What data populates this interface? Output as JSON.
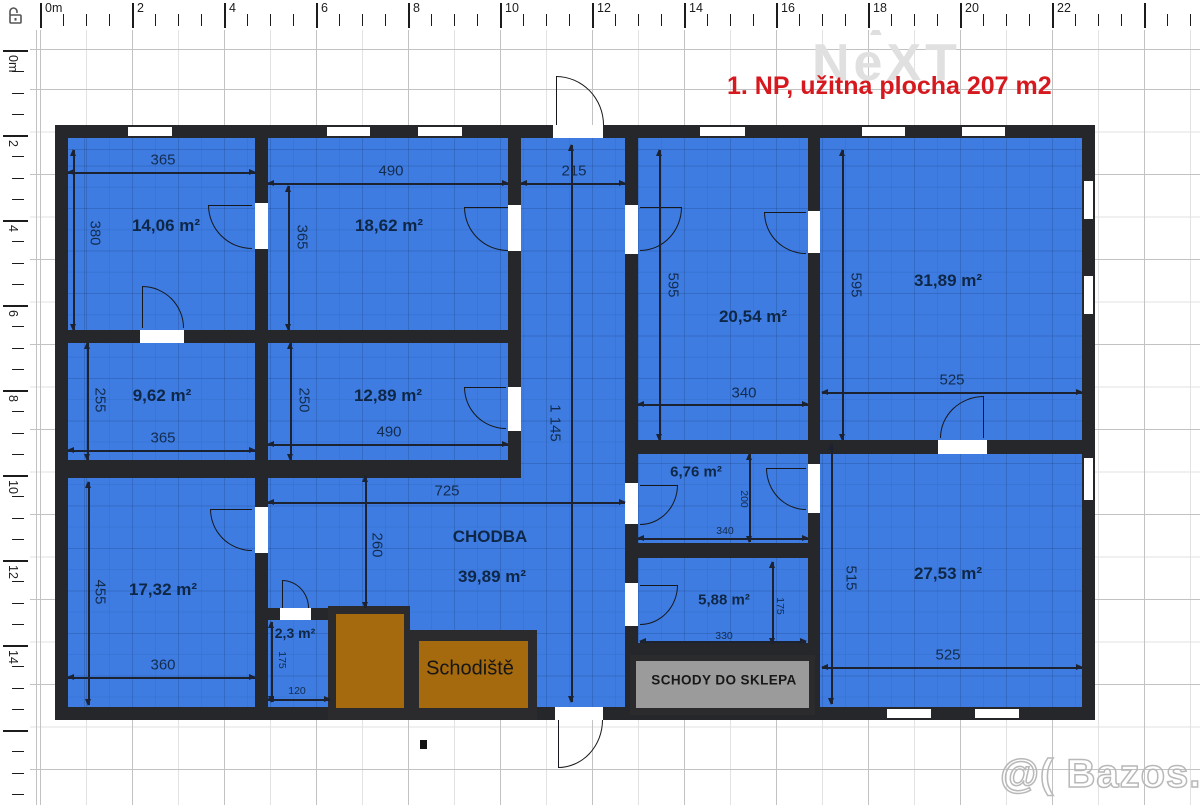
{
  "title": {
    "text": "1. NP, užitna plocha 207 m2"
  },
  "watermarks": {
    "next": "NeXT",
    "next_caret": "▲",
    "bazos": "@( Bazos.cz"
  },
  "rulers": {
    "top_labels": [
      "0m",
      "2",
      "4",
      "6",
      "8",
      "10",
      "12",
      "14",
      "16",
      "18",
      "20",
      "22"
    ],
    "left_labels": [
      "0m",
      "2",
      "4",
      "6",
      "8",
      "10",
      "12",
      "14"
    ]
  },
  "rooms": {
    "r1406": "14,06 m²",
    "r1862": "18,62 m²",
    "r962": "9,62 m²",
    "r1289": "12,89 m²",
    "r1732": "17,32 m²",
    "r23": "2,3 m²",
    "r2054": "20,54 m²",
    "r3189": "31,89 m²",
    "r676": "6,76 m²",
    "r588": "5,88 m²",
    "r2753": "27,53 m²",
    "chodba_name": "CHODBA",
    "chodba_area": "39,89 m²",
    "schodiste": "Schodiště",
    "schody_sklep": "SCHODY DO SKLEPA"
  },
  "dims": {
    "d365a": "365",
    "d490a": "490",
    "d215": "215",
    "d380": "380",
    "d365b": "365",
    "d595a": "595",
    "d595b": "595",
    "d255": "255",
    "d250": "250",
    "d365c": "365",
    "d490b": "490",
    "d725": "725",
    "d1145": "1 145",
    "d340a": "340",
    "d525a": "525",
    "d260": "260",
    "d455": "455",
    "d360": "360",
    "d175a": "175",
    "d120": "120",
    "d200": "200",
    "d340b": "340",
    "d175b": "175",
    "d330": "330",
    "d515": "515",
    "d525b": "525"
  },
  "colors": {
    "floor_blue": "#3e7ce1",
    "wall": "#26272b",
    "stair_brown": "#a5690e",
    "basement_gray": "#9b9b9b",
    "title_red": "#d6191f"
  }
}
